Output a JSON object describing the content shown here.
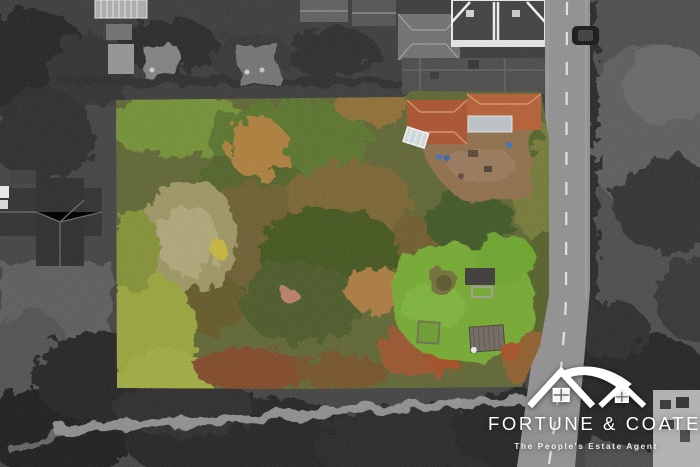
{
  "brand": {
    "name": "FORTUNE & COATES",
    "tagline": "The People's Estate Agent",
    "icon": "twin-houses-icon",
    "text_color": "#ffffff"
  },
  "scene": {
    "type": "aerial-drone-photograph",
    "treatment": "surroundings rendered in grayscale, marketed plot shown in full colour",
    "plot": {
      "contents": [
        "autumn woodland garden",
        "house with red tiled roof",
        "brown dirt yard with bins",
        "white greenhouse",
        "lawn with shed, gazebo, round bush and sandpit frame"
      ]
    },
    "surroundings": [
      "terraced houses and gardens along top",
      "main road with dashed centre line on right",
      "parked car on road",
      "field with large trees right of road",
      "dark woodland and pale footpath track along bottom",
      "dark hipped-roof building on left"
    ],
    "palette": {
      "lawn_green": "#6fa52f",
      "scrub_olive": "#5b6130",
      "autumn_orange": "#a87a38",
      "roof_red": "#a64e2c",
      "dirt_brown": "#8a6a46",
      "road_gray": "#8c8c8c",
      "background_gray": "#3f3f3f"
    }
  }
}
